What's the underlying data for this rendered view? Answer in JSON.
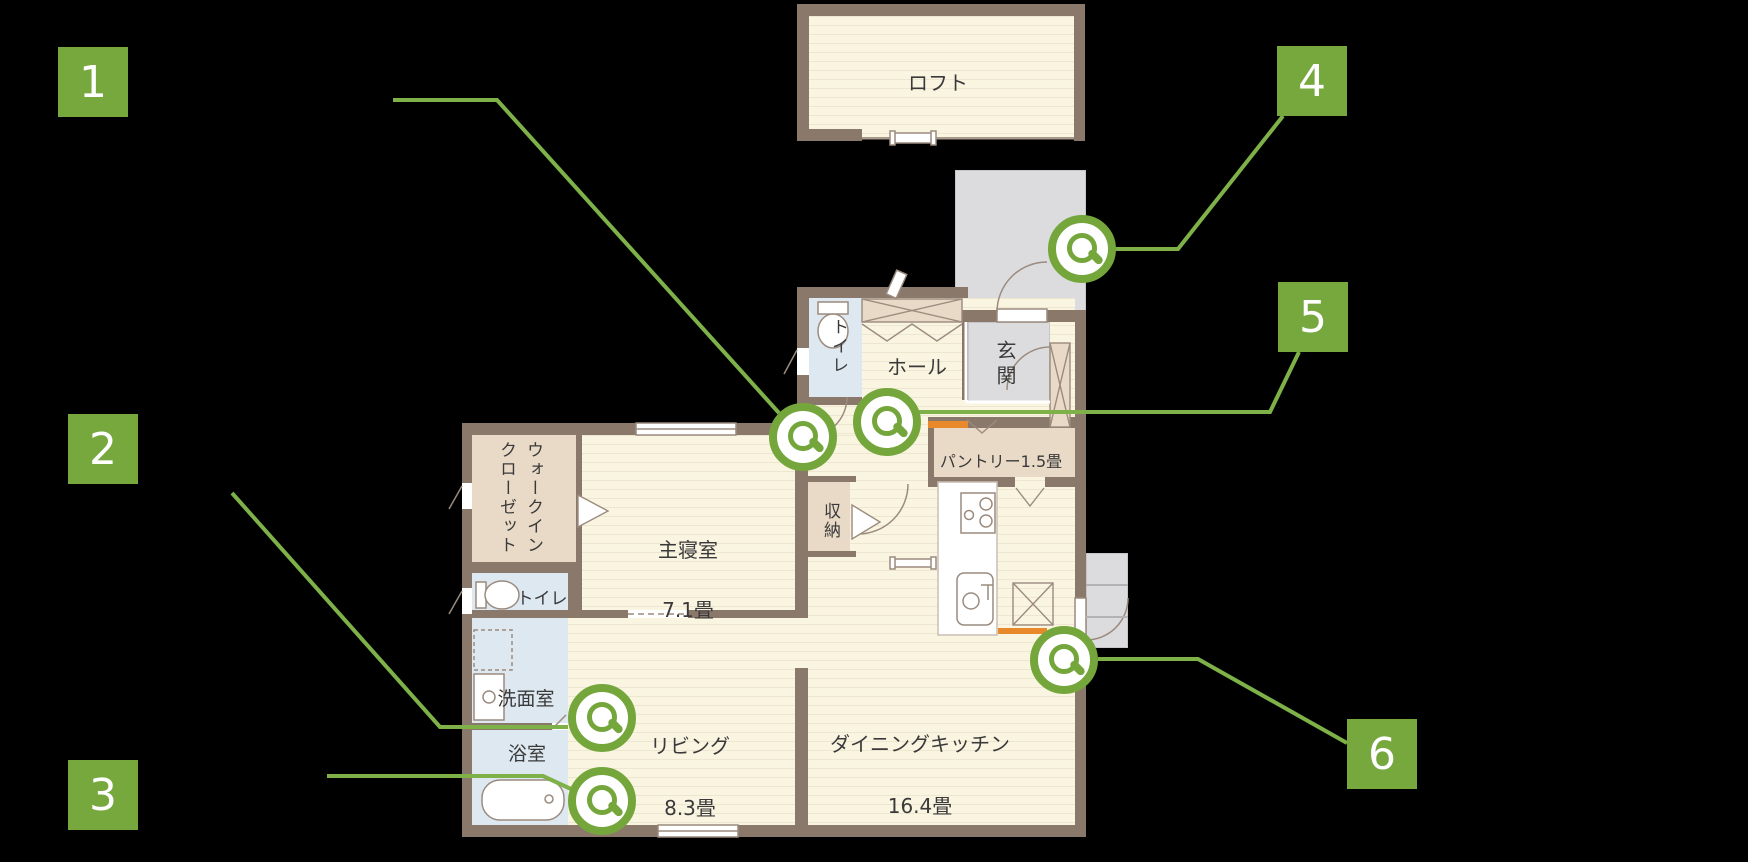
{
  "scene": {
    "background": "#000000",
    "accent_green": "#76a83e",
    "line_green": "#7eb148",
    "wall_color": "#8a796b",
    "orange_accent": "#e8892b"
  },
  "floorplan": {
    "rooms": {
      "loft": {
        "label": "ロフト"
      },
      "toilet_upper": {
        "label": "トイレ"
      },
      "hall": {
        "label": "ホール"
      },
      "entrance": {
        "label": "玄関"
      },
      "pantry": {
        "label": "パントリー1.5畳"
      },
      "walk_in_closet": {
        "line1": "ウォークイン",
        "line2": "クローゼット"
      },
      "master_bedroom": {
        "label": "主寝室",
        "size": "7.1畳"
      },
      "storage": {
        "label": "収納"
      },
      "toilet_lower": {
        "label": "トイレ"
      },
      "washroom": {
        "label": "洗面室"
      },
      "bathroom": {
        "label": "浴室"
      },
      "living": {
        "label": "リビング",
        "size": "8.3畳"
      },
      "dining_kitchen": {
        "label": "ダイニングキッチン",
        "size": "16.4畳"
      }
    },
    "markers": [
      {
        "number": "1"
      },
      {
        "number": "2"
      },
      {
        "number": "3"
      },
      {
        "number": "4"
      },
      {
        "number": "5"
      },
      {
        "number": "6"
      }
    ]
  }
}
